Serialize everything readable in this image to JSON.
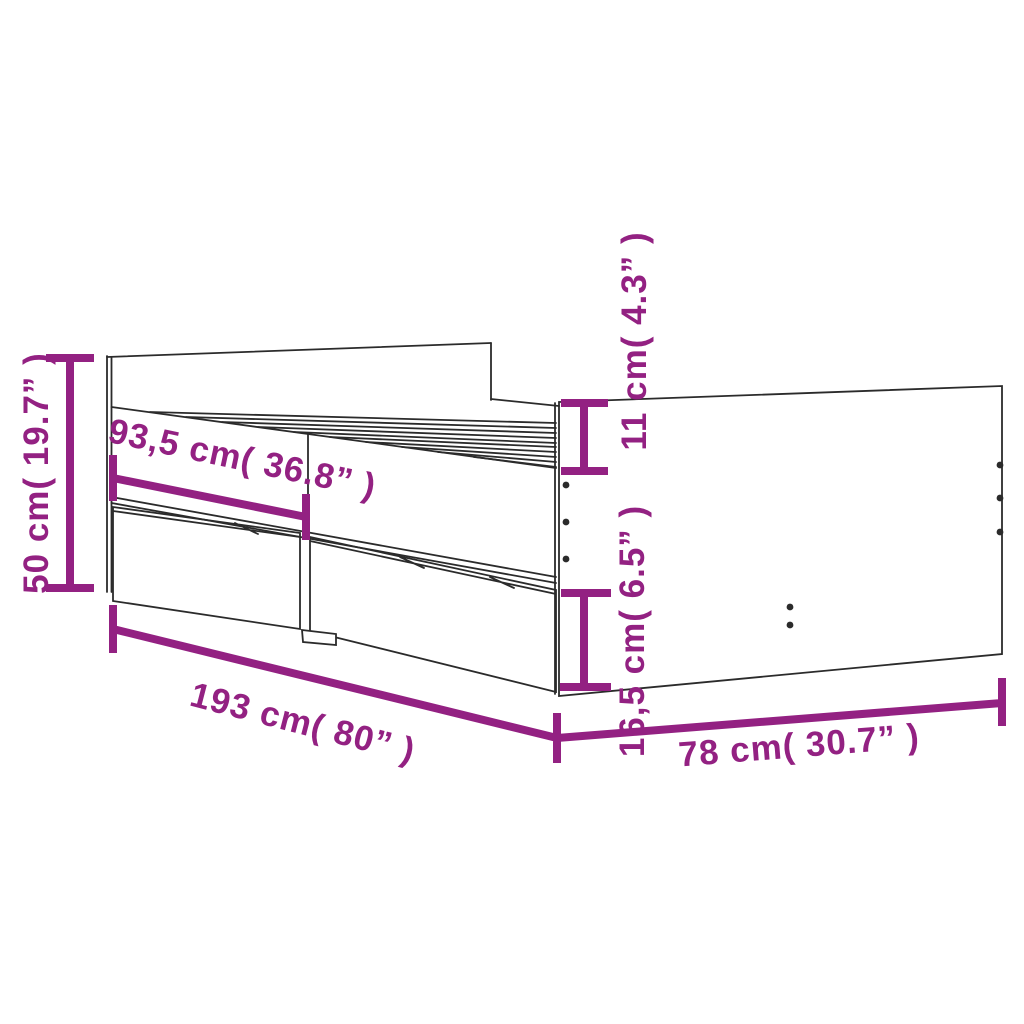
{
  "colors": {
    "accent": "#932182",
    "ink": "#2b2b2b",
    "background": "#ffffff"
  },
  "dimensions": [
    {
      "id": "total-height",
      "label": "50 cm( 19.7” )",
      "cm": "50",
      "inches": "19.7",
      "orientation": "vertical"
    },
    {
      "id": "side-section-width",
      "label": "93,5 cm( 36.8” )",
      "cm": "93,5",
      "inches": "36.8",
      "orientation": "diagonal"
    },
    {
      "id": "footboard-top-height",
      "label": "11 cm( 4.3” )",
      "cm": "11",
      "inches": "4.3",
      "orientation": "vertical"
    },
    {
      "id": "drawer-height",
      "label": "16,5 cm( 6.5” )",
      "cm": "16,5",
      "inches": "6.5",
      "orientation": "vertical"
    },
    {
      "id": "total-length",
      "label": "193 cm( 80” )",
      "cm": "193",
      "inches": "80",
      "orientation": "diagonal"
    },
    {
      "id": "total-width",
      "label": "78 cm( 30.7” )",
      "cm": "78",
      "inches": "30.7",
      "orientation": "diagonal"
    }
  ]
}
